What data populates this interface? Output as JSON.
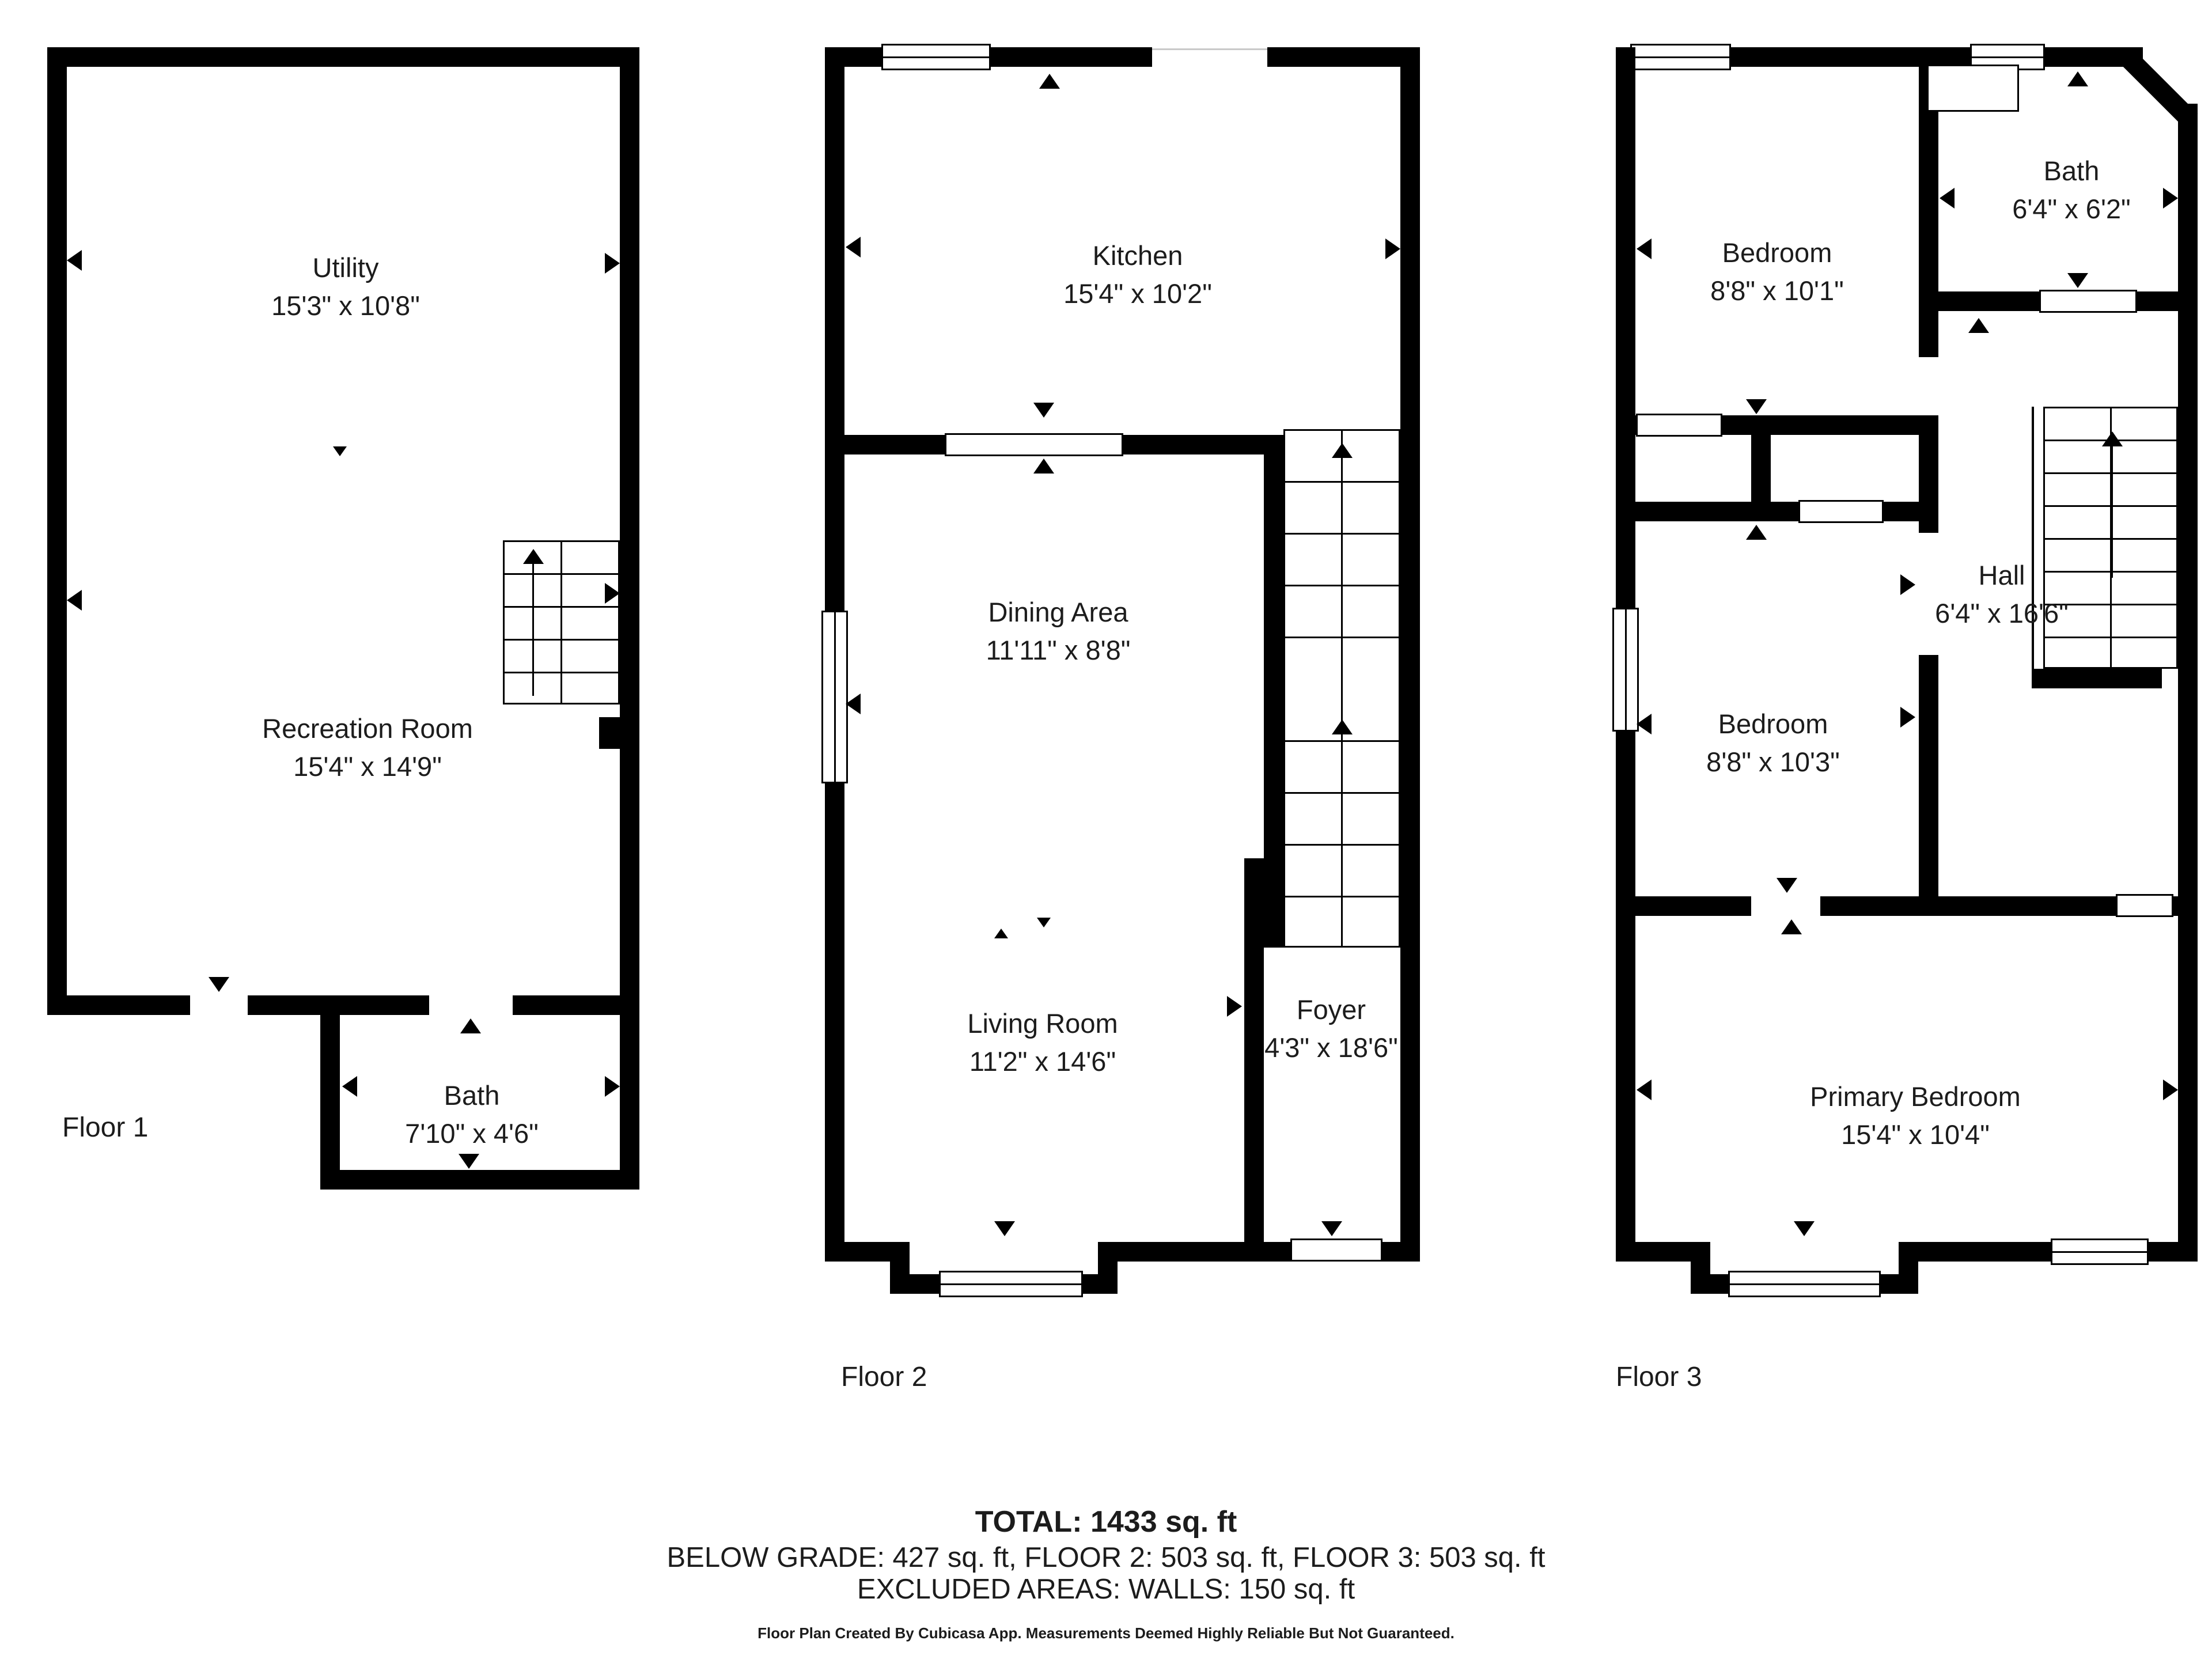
{
  "floors": [
    {
      "label": "Floor 1",
      "rooms": [
        {
          "name": "Utility",
          "dims": "15'3\" x 10'8\""
        },
        {
          "name": "Recreation Room",
          "dims": "15'4\" x 14'9\""
        },
        {
          "name": "Bath",
          "dims": "7'10\" x 4'6\""
        }
      ]
    },
    {
      "label": "Floor 2",
      "rooms": [
        {
          "name": "Kitchen",
          "dims": "15'4\" x 10'2\""
        },
        {
          "name": "Dining Area",
          "dims": "11'11\" x 8'8\""
        },
        {
          "name": "Living Room",
          "dims": "11'2\" x 14'6\""
        },
        {
          "name": "Foyer",
          "dims": "4'3\" x 18'6\""
        }
      ]
    },
    {
      "label": "Floor 3",
      "rooms": [
        {
          "name": "Bedroom",
          "dims": "8'8\" x 10'1\""
        },
        {
          "name": "Bath",
          "dims": "6'4\" x 6'2\""
        },
        {
          "name": "Hall",
          "dims": "6'4\" x 16'6\""
        },
        {
          "name": "Bedroom",
          "dims": "8'8\" x 10'3\""
        },
        {
          "name": "Primary Bedroom",
          "dims": "15'4\" x 10'4\""
        }
      ]
    }
  ],
  "summary": {
    "total": "TOTAL: 1433 sq. ft",
    "breakdown": "BELOW GRADE: 427 sq. ft, FLOOR 2: 503 sq. ft, FLOOR 3: 503 sq. ft",
    "excluded": "EXCLUDED AREAS: WALLS: 150 sq. ft",
    "disclaimer": "Floor Plan Created By Cubicasa App. Measurements Deemed Highly Reliable But Not Guaranteed."
  },
  "colors": {
    "wall": "#000000",
    "background": "#ffffff",
    "text": "#1c1c1c"
  }
}
